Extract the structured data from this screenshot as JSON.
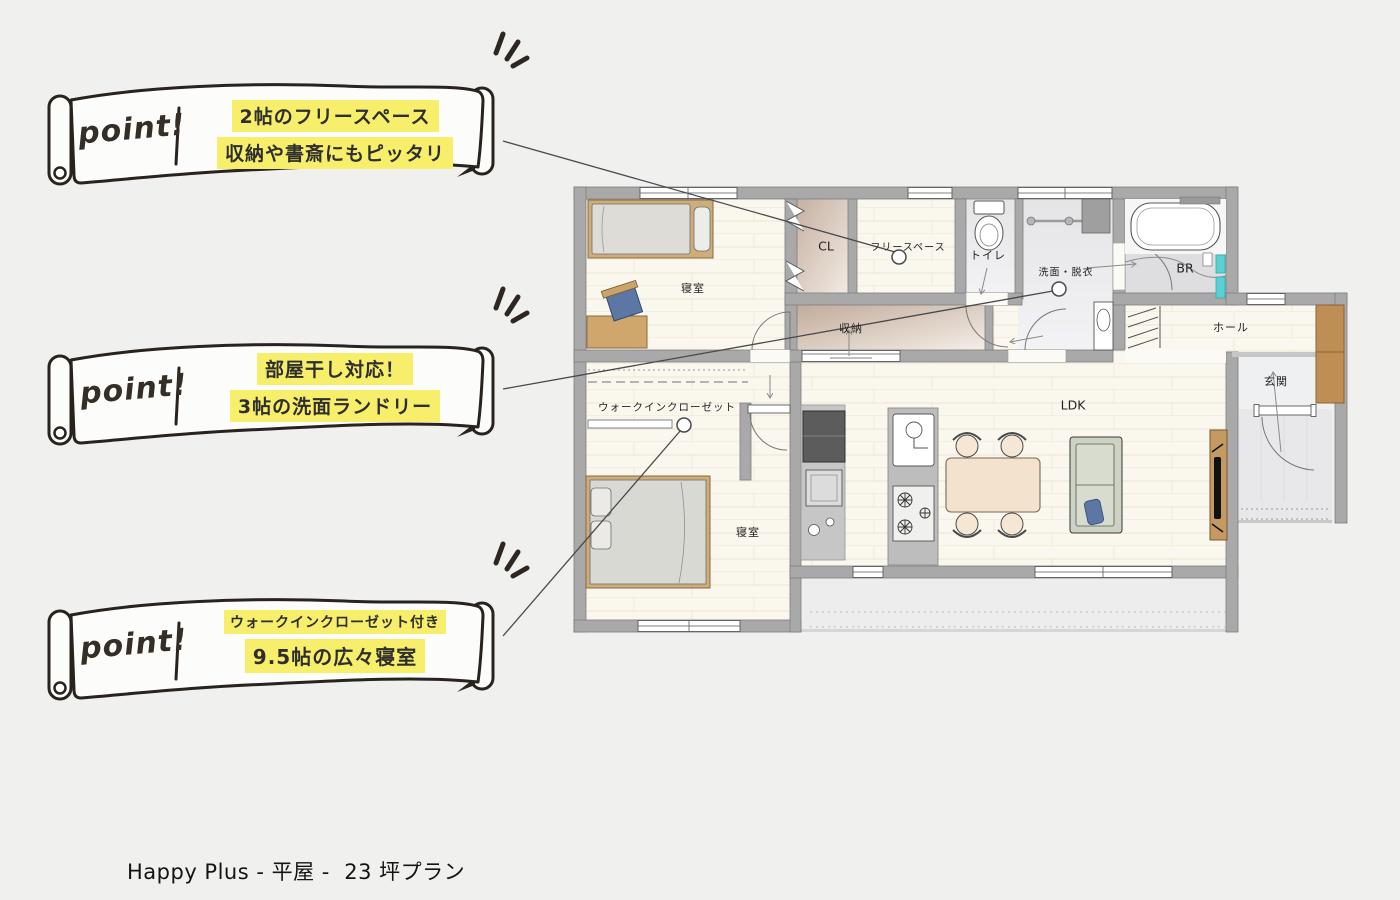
{
  "page": {
    "title": "Happy Plus - 平屋 -  23 坪プラン"
  },
  "points": [
    {
      "badge": "point!",
      "lines": [
        "2帖のフリースペース",
        "収納や書斎にもピッタリ"
      ]
    },
    {
      "badge": "point!",
      "lines": [
        "部屋干し対応！",
        "3帖の洗面ランドリー"
      ]
    },
    {
      "badge": "point!",
      "lines": [
        "ウォークインクローゼット付き",
        "9.5帖の広々寝室"
      ]
    }
  ],
  "floorplan": {
    "rooms": [
      {
        "label": "寝室"
      },
      {
        "label": "CL"
      },
      {
        "label": "フリースペース"
      },
      {
        "label": "トイレ"
      },
      {
        "label": "洗面・脱衣"
      },
      {
        "label": "BR"
      },
      {
        "label": "ホール"
      },
      {
        "label": "玄関"
      },
      {
        "label": "収納"
      },
      {
        "label": "ウォークインクローゼット"
      },
      {
        "label": "寝室"
      },
      {
        "label": "LDK"
      }
    ],
    "colors": {
      "wall": "#a9a9a9",
      "floor": "#faf7ee",
      "wet_area": "#e9e9eb",
      "closet": "#cbb6a8",
      "wood": "#cfad7a",
      "accent_teal": "#58d0d4",
      "highlight": "#f7ee6b"
    }
  }
}
